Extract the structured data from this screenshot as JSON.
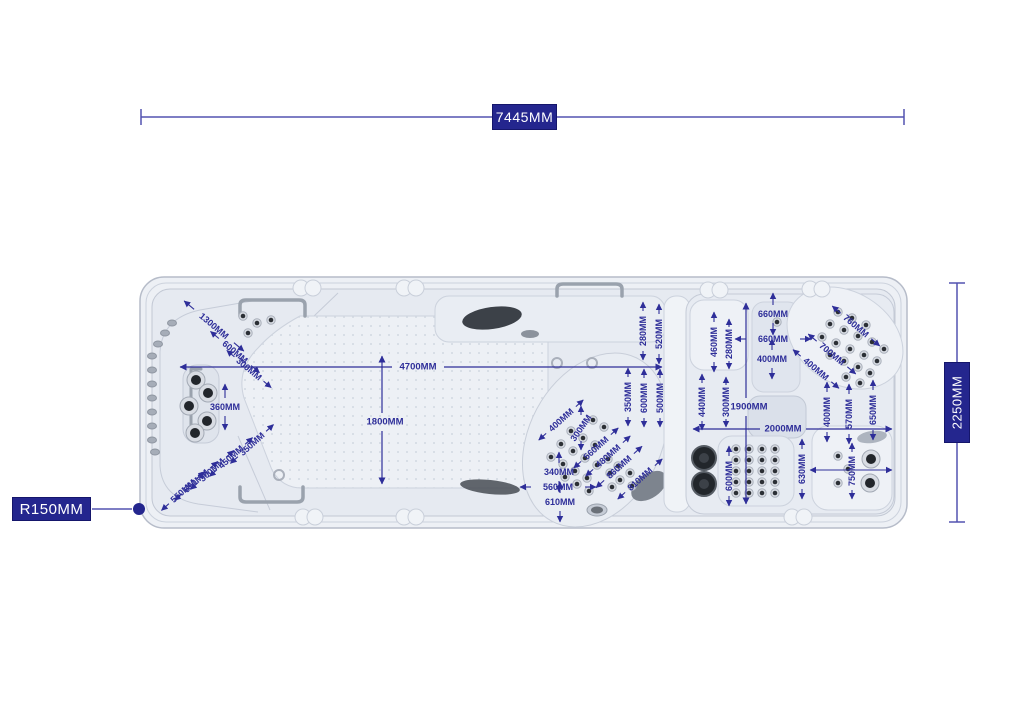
{
  "diagram": {
    "title": "Swim spa top view dimension drawing",
    "dims": {
      "overall_length": "7445MM",
      "overall_width": "2250MM",
      "corner_radius": "R150MM",
      "swim_length": "4700MM",
      "swim_width": "1800MM",
      "right_width": "1900MM",
      "right_length": "2000MM"
    },
    "colors": {
      "dim_blue": "#2e2e99",
      "box_blue": "#24268e",
      "line_blue": "#5353b0",
      "shell": "#edf0f5",
      "basin": "#e6eaf1",
      "dark_part": "#23262b"
    },
    "annotations": [
      {
        "t": "1300MM",
        "x": 214,
        "y": 326,
        "rot": 40,
        "ax": 40,
        "gap": 26,
        "al": 13
      },
      {
        "t": "600MM",
        "x": 235,
        "y": 352,
        "rot": 40,
        "ax": 40,
        "gap": 21,
        "al": 11
      },
      {
        "t": "300MM",
        "x": 249,
        "y": 369,
        "rot": 40,
        "ax": 40,
        "gap": 19,
        "al": 10
      },
      {
        "t": "360MM",
        "x": 225,
        "y": 407,
        "rot": 0,
        "ax": 90,
        "gap": 9,
        "al": 14
      },
      {
        "t": "350MM",
        "x": 252,
        "y": 444,
        "rot": -42,
        "ax": -42,
        "gap": 19,
        "al": 10
      },
      {
        "t": "450MM",
        "x": 231,
        "y": 457,
        "rot": -42,
        "ax": -42,
        "gap": 19,
        "al": 10
      },
      {
        "t": "300MM",
        "x": 212,
        "y": 470,
        "rot": -42,
        "ax": -42,
        "gap": 19,
        "al": 10
      },
      {
        "t": "650MM",
        "x": 196,
        "y": 481,
        "rot": -42,
        "ax": -42,
        "gap": 19,
        "al": 10
      },
      {
        "t": "550MM",
        "x": 183,
        "y": 491,
        "rot": -42,
        "ax": -42,
        "gap": 19,
        "al": 10
      },
      {
        "t": "400MM",
        "x": 561,
        "y": 420,
        "rot": -42,
        "ax": -42,
        "gap": 20,
        "al": 10
      },
      {
        "t": "300MM",
        "x": 581,
        "y": 428,
        "rot": -55,
        "ax": 90,
        "gap": 13,
        "al": 9
      },
      {
        "t": "560MM",
        "x": 596,
        "y": 448,
        "rot": -42,
        "ax": -42,
        "gap": 20,
        "al": 10
      },
      {
        "t": "480MM",
        "x": 608,
        "y": 456,
        "rot": -42,
        "ax": -42,
        "gap": 20,
        "al": 10
      },
      {
        "t": "860MM",
        "x": 619,
        "y": 467,
        "rot": -42,
        "ax": -42,
        "gap": 20,
        "al": 11
      },
      {
        "t": "810MM",
        "x": 640,
        "y": 479,
        "rot": -42,
        "ax": -42,
        "gap": 20,
        "al": 10
      },
      {
        "t": "340MM",
        "x": 559,
        "y": 472,
        "rot": 0,
        "ax": 90,
        "gap": 9,
        "al": 11
      },
      {
        "t": "560MM",
        "x": 558,
        "y": 487,
        "rot": 0,
        "ax": 0,
        "gap": 27,
        "al": 11
      },
      {
        "t": "610MM",
        "x": 560,
        "y": 502,
        "rot": 0,
        "ax": 90,
        "gap": 9,
        "al": 11
      },
      {
        "t": "350MM",
        "x": 628,
        "y": 397,
        "rot": -90,
        "ax": 90,
        "gap": 20,
        "al": 9
      },
      {
        "t": "600MM",
        "x": 644,
        "y": 398,
        "rot": -90,
        "ax": 90,
        "gap": 20,
        "al": 9
      },
      {
        "t": "500MM",
        "x": 660,
        "y": 398,
        "rot": -90,
        "ax": 90,
        "gap": 20,
        "al": 9
      },
      {
        "t": "280MM",
        "x": 643,
        "y": 331,
        "rot": -90,
        "ax": 90,
        "gap": 20,
        "al": 9
      },
      {
        "t": "520MM",
        "x": 659,
        "y": 334,
        "rot": -90,
        "ax": 90,
        "gap": 20,
        "al": 10
      },
      {
        "t": "660MM",
        "x": 773,
        "y": 314,
        "rot": 0,
        "ax": 90,
        "gap": 9,
        "al": 12
      },
      {
        "t": "660MM",
        "x": 773,
        "y": 339,
        "rot": 0,
        "ax": 0,
        "gap": 27,
        "al": 11
      },
      {
        "t": "400MM",
        "x": 772,
        "y": 359,
        "rot": 0,
        "ax": 90,
        "gap": 9,
        "al": 11
      },
      {
        "t": "460MM",
        "x": 714,
        "y": 342,
        "rot": -90,
        "ax": 90,
        "gap": 20,
        "al": 10
      },
      {
        "t": "280MM",
        "x": 729,
        "y": 344,
        "rot": -90,
        "ax": 90,
        "gap": 17,
        "al": 8
      },
      {
        "t": "760MM",
        "x": 856,
        "y": 326,
        "rot": 40,
        "ax": 40,
        "gap": 20,
        "al": 11
      },
      {
        "t": "700MM",
        "x": 832,
        "y": 354,
        "rot": 40,
        "ax": 40,
        "gap": 20,
        "al": 11
      },
      {
        "t": "400MM",
        "x": 816,
        "y": 369,
        "rot": 40,
        "ax": 40,
        "gap": 20,
        "al": 10
      },
      {
        "t": "440MM",
        "x": 702,
        "y": 402,
        "rot": -90,
        "ax": 90,
        "gap": 19,
        "al": 9
      },
      {
        "t": "300MM",
        "x": 726,
        "y": 402,
        "rot": -90,
        "ax": 90,
        "gap": 17,
        "al": 8
      },
      {
        "t": "400MM",
        "x": 827,
        "y": 412,
        "rot": -90,
        "ax": 90,
        "gap": 20,
        "al": 10
      },
      {
        "t": "570MM",
        "x": 849,
        "y": 414,
        "rot": -90,
        "ax": 90,
        "gap": 20,
        "al": 10
      },
      {
        "t": "650MM",
        "x": 873,
        "y": 410,
        "rot": -90,
        "ax": 90,
        "gap": 20,
        "al": 10
      },
      {
        "t": "600MM",
        "x": 729,
        "y": 476,
        "rot": -90,
        "ax": 90,
        "gap": 20,
        "al": 10
      },
      {
        "t": "630MM",
        "x": 802,
        "y": 469,
        "rot": -90,
        "ax": 90,
        "gap": 20,
        "al": 10
      },
      {
        "t": "750MM",
        "x": 852,
        "y": 471,
        "rot": -90,
        "ax": 90,
        "gap": 19,
        "al": 9
      }
    ],
    "extra_arrow_lines": [
      {
        "x1": 810,
        "y1": 470,
        "x2": 892,
        "y2": 470
      }
    ],
    "jets": {
      "side_ovals": [
        [
          152,
          356
        ],
        [
          152,
          370
        ],
        [
          152,
          384
        ],
        [
          152,
          398
        ],
        [
          152,
          412
        ],
        [
          152,
          426
        ],
        [
          152,
          440
        ],
        [
          155,
          452
        ],
        [
          158,
          344
        ],
        [
          165,
          333
        ],
        [
          172,
          323
        ]
      ],
      "chrome_small": [
        [
          243,
          316
        ],
        [
          257,
          323
        ],
        [
          271,
          320
        ],
        [
          248,
          333
        ],
        [
          571,
          431
        ],
        [
          583,
          438
        ],
        [
          595,
          445
        ],
        [
          561,
          444
        ],
        [
          573,
          451
        ],
        [
          585,
          458
        ],
        [
          597,
          465
        ],
        [
          551,
          457
        ],
        [
          563,
          464
        ],
        [
          575,
          471
        ],
        [
          587,
          478
        ],
        [
          565,
          477
        ],
        [
          577,
          484
        ],
        [
          589,
          491
        ],
        [
          608,
          459
        ],
        [
          618,
          466
        ],
        [
          610,
          473
        ],
        [
          620,
          480
        ],
        [
          612,
          487
        ],
        [
          630,
          473
        ],
        [
          632,
          486
        ],
        [
          593,
          420
        ],
        [
          604,
          427
        ],
        [
          838,
          312
        ],
        [
          852,
          318
        ],
        [
          866,
          325
        ],
        [
          830,
          324
        ],
        [
          844,
          330
        ],
        [
          858,
          336
        ],
        [
          872,
          342
        ],
        [
          884,
          349
        ],
        [
          822,
          337
        ],
        [
          836,
          343
        ],
        [
          850,
          349
        ],
        [
          864,
          355
        ],
        [
          877,
          361
        ],
        [
          830,
          355
        ],
        [
          844,
          361
        ],
        [
          858,
          367
        ],
        [
          870,
          373
        ],
        [
          846,
          377
        ],
        [
          860,
          383
        ],
        [
          736,
          449
        ],
        [
          749,
          449
        ],
        [
          762,
          449
        ],
        [
          775,
          449
        ],
        [
          736,
          460
        ],
        [
          749,
          460
        ],
        [
          762,
          460
        ],
        [
          775,
          460
        ],
        [
          736,
          471
        ],
        [
          749,
          471
        ],
        [
          762,
          471
        ],
        [
          775,
          471
        ],
        [
          736,
          482
        ],
        [
          749,
          482
        ],
        [
          762,
          482
        ],
        [
          775,
          482
        ],
        [
          736,
          493
        ],
        [
          749,
          493
        ],
        [
          762,
          493
        ],
        [
          775,
          493
        ],
        [
          838,
          456
        ],
        [
          848,
          469
        ],
        [
          838,
          483
        ],
        [
          777,
          322
        ]
      ],
      "chrome_big": [
        [
          196,
          380
        ],
        [
          208,
          393
        ],
        [
          189,
          406
        ],
        [
          207,
          421
        ],
        [
          195,
          433
        ],
        [
          871,
          459
        ],
        [
          870,
          483
        ]
      ],
      "rings": [
        [
          557,
          363
        ],
        [
          592,
          363
        ],
        [
          279,
          475
        ]
      ],
      "speakers": [
        [
          704,
          458
        ],
        [
          704,
          484
        ]
      ]
    }
  }
}
